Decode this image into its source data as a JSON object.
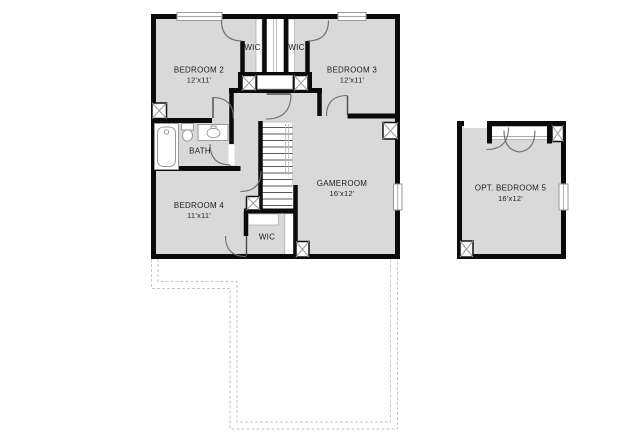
{
  "floor_plan": {
    "rooms": {
      "bedroom2": {
        "label": "BEDROOM 2",
        "dims": "12'x11'"
      },
      "bedroom3": {
        "label": "BEDROOM 3",
        "dims": "12'x11'"
      },
      "bedroom4": {
        "label": "BEDROOM 4",
        "dims": "11'x11'"
      },
      "gameroom": {
        "label": "GAMEROOM",
        "dims": "16'x12'"
      },
      "opt_bedroom5": {
        "label": "OPT. BEDROOM 5",
        "dims": "16'x12'"
      },
      "bath": {
        "label": "BATH"
      },
      "wic_top_left": {
        "label": "WIC"
      },
      "wic_top_right": {
        "label": "WIC"
      },
      "wic_bottom": {
        "label": "WIC"
      }
    },
    "colors": {
      "wall": "#0b0b0b",
      "room_fill": "#d9d9d9",
      "fixture_stroke": "#9a9a9a",
      "dashed_outline": "#c6c6c6",
      "background": "#ffffff"
    }
  }
}
